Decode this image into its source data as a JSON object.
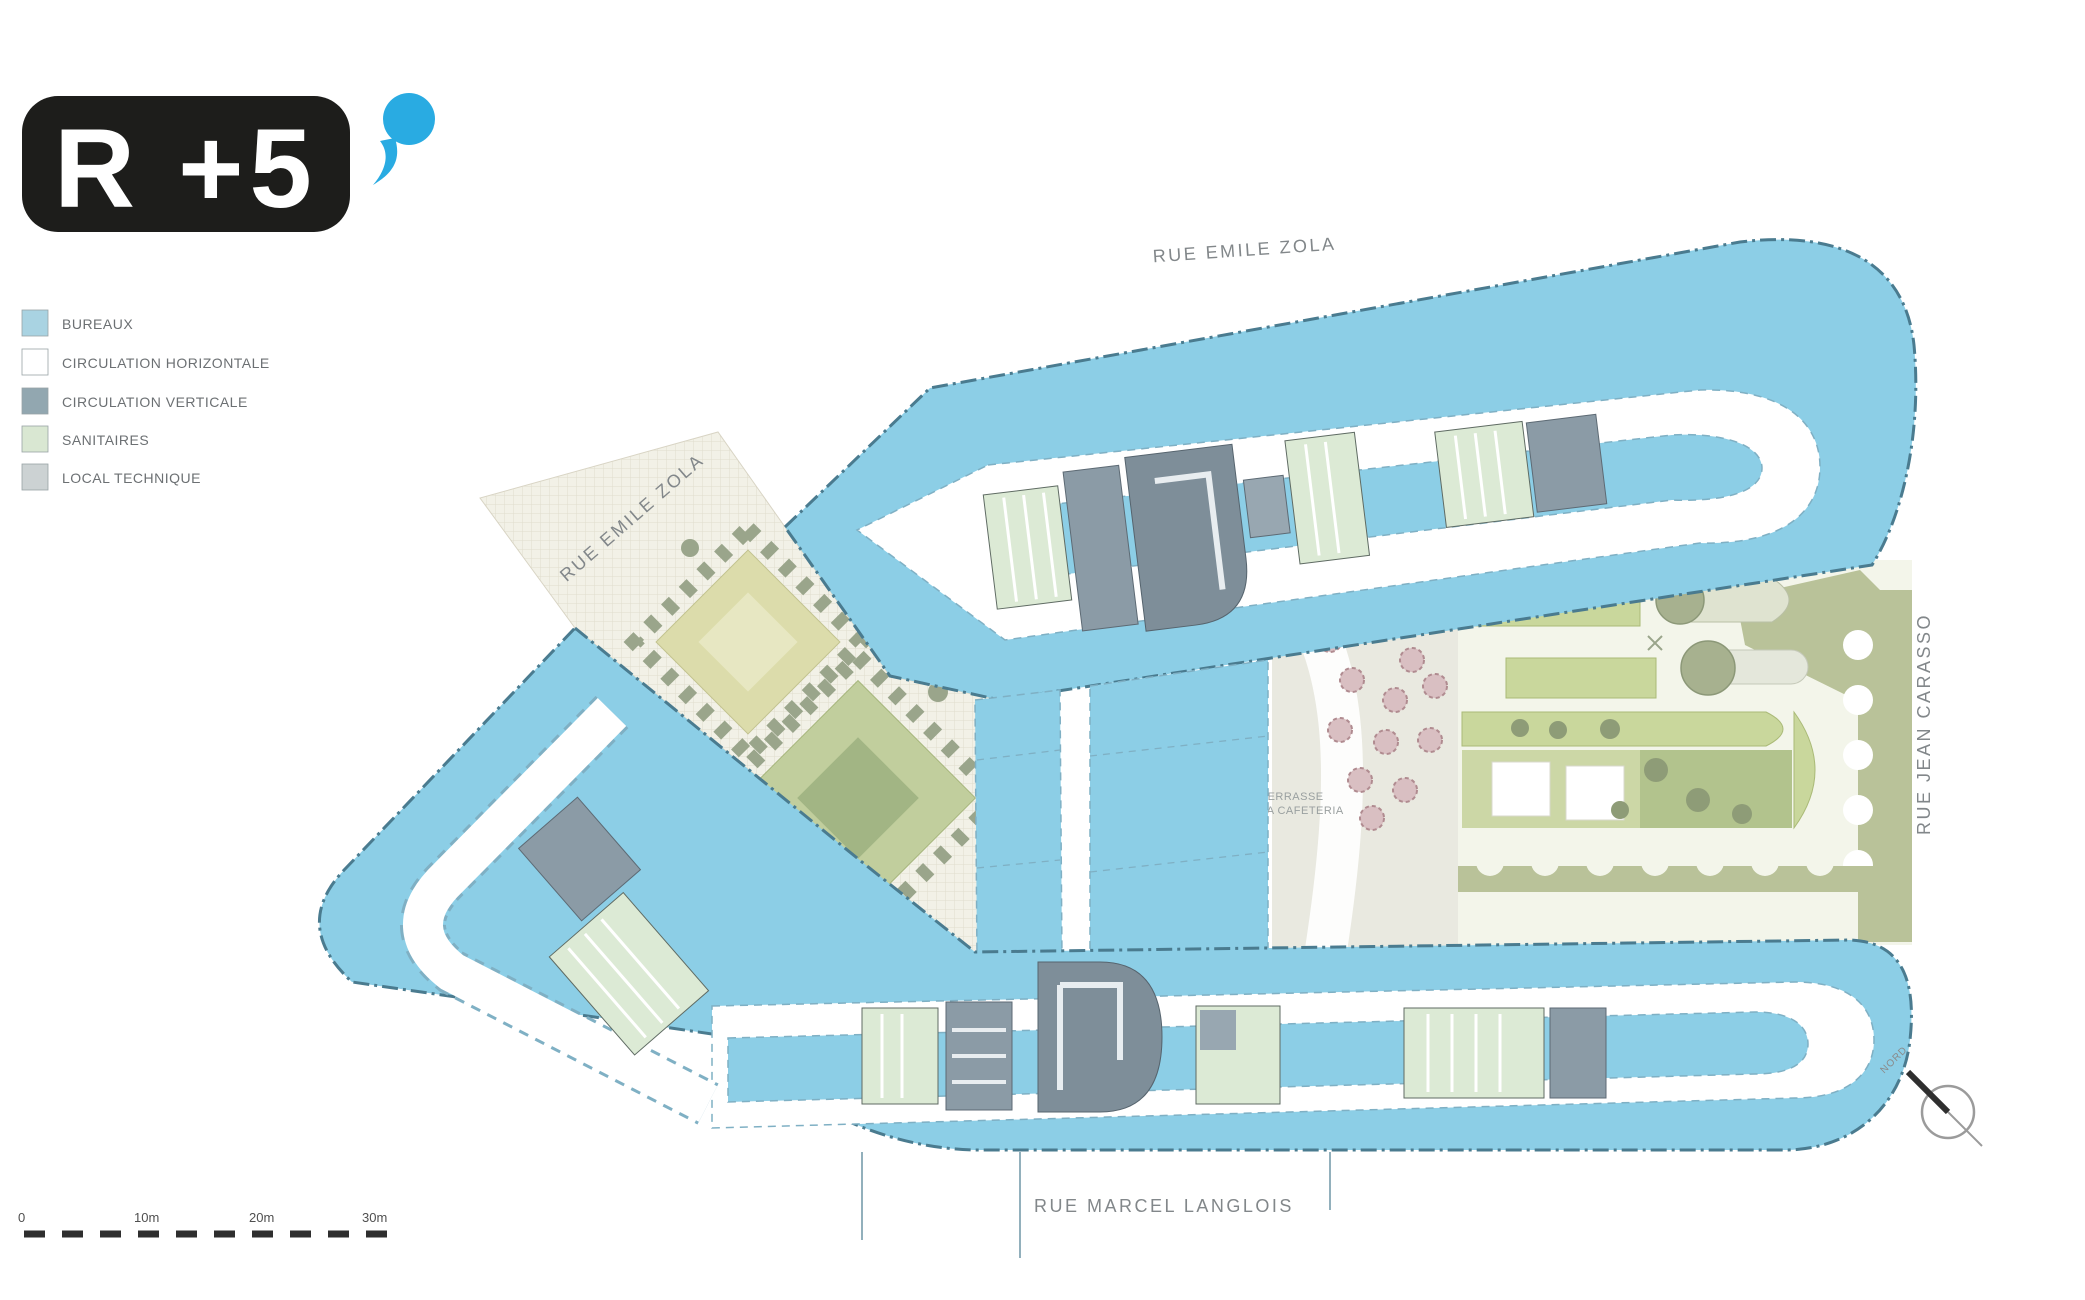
{
  "title": {
    "floor_label": "R +5"
  },
  "legend": {
    "items": [
      {
        "label": "BUREAUX",
        "color": "#a9d3e2"
      },
      {
        "label": "CIRCULATION HORIZONTALE",
        "color": "#ffffff"
      },
      {
        "label": "CIRCULATION VERTICALE",
        "color": "#92a7b0"
      },
      {
        "label": "SANITAIRES",
        "color": "#d9e7d2"
      },
      {
        "label": "LOCAL TECHNIQUE",
        "color": "#ccd2d3"
      }
    ]
  },
  "streets": {
    "top": "RUE EMILE ZOLA",
    "diagonal": "RUE EMILE ZOLA",
    "right": "RUE JEAN CARASSO",
    "bottom": "RUE MARCEL LANGLOIS"
  },
  "annotations": {
    "terrace_line1": "TERRASSE",
    "terrace_line2": "DE LA CAFETERIA",
    "north_label": "NORD"
  },
  "scale_bar": {
    "ticks": [
      "0",
      "10m",
      "20m",
      "30m"
    ]
  },
  "colors": {
    "bureaux_fill": "#8ccee6",
    "outline": "#4a7b8f",
    "corridor_edge": "#7fb0c4",
    "circulation_verticale": "#7e8e99",
    "sanitaires": "#dcead5",
    "local_technique": "#ccd2d3",
    "garden_green": "#c9d79c",
    "olive_band": "#b9c299",
    "logo_background": "#1d1d1b",
    "accent_blue": "#29abe2"
  }
}
